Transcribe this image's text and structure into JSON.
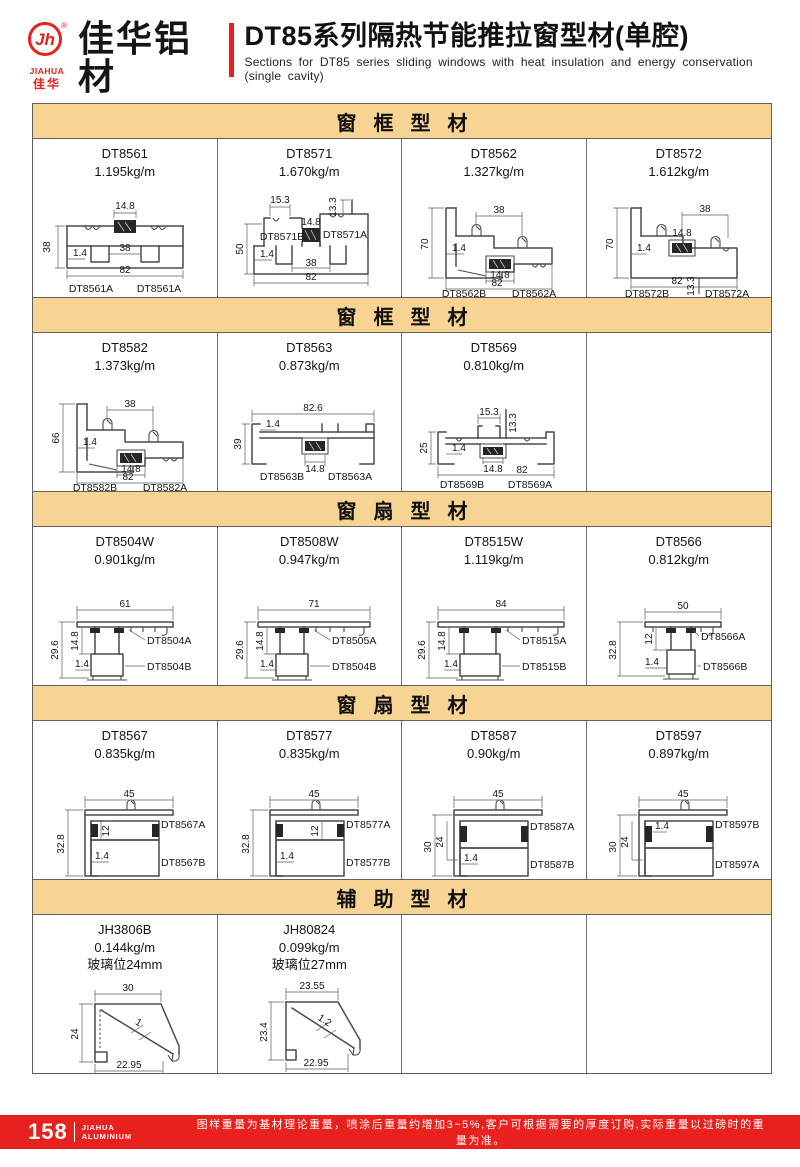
{
  "brand": {
    "monogram": "Jh",
    "registered": "®",
    "name_en": "JIAHUA",
    "name_cn_small": "佳华",
    "name": "佳华铝材",
    "slogan": "世界利中华 · 铝材用佳华"
  },
  "title": {
    "cn": "DT85系列隔热节能推拉窗型材(单腔)",
    "en": "Sections for DT85 series sliding windows with heat insulation and energy conservation (single cavity)"
  },
  "colors": {
    "accent_red": "#e8201e",
    "band_tan": "#f7d494"
  },
  "sections": [
    {
      "title": "窗框型材",
      "cells": [
        {
          "code": "DT8561",
          "weight": "1.195kg/m",
          "d": {
            "top": "14.8",
            "left": "38",
            "wall": "1.4",
            "inner": "38",
            "overall": "82",
            "lbl_l": "DT8561A",
            "lbl_r": "DT8561A"
          }
        },
        {
          "code": "DT8571",
          "weight": "1.670kg/m",
          "d": {
            "top_left": "15.3",
            "top_right": "13.3",
            "center": "14.8",
            "left": "50",
            "wall": "1.4",
            "inner": "38",
            "overall": "82",
            "lbl_l": "DT8571B",
            "lbl_r": "DT8571A"
          }
        },
        {
          "code": "DT8562",
          "weight": "1.327kg/m",
          "d": {
            "top": "38",
            "left": "70",
            "wall": "1.4",
            "center": "14.8",
            "overall": "82",
            "lbl_l": "DT8562B",
            "lbl_r": "DT8562A"
          }
        },
        {
          "code": "DT8572",
          "weight": "1.612kg/m",
          "d": {
            "top": "38",
            "left": "70",
            "wall": "1.4",
            "center": "14.8",
            "overall": "82",
            "right": "13.3",
            "lbl_l": "DT8572B",
            "lbl_r": "DT8572A"
          }
        }
      ]
    },
    {
      "title": "窗框型材",
      "cells": [
        {
          "code": "DT8582",
          "weight": "1.373kg/m",
          "d": {
            "top": "38",
            "left": "66",
            "wall": "1.4",
            "center": "14.8",
            "overall": "82",
            "lbl_l": "DT8582B",
            "lbl_r": "DT8582A"
          }
        },
        {
          "code": "DT8563",
          "weight": "0.873kg/m",
          "d": {
            "top": "82.6",
            "left": "39",
            "wall": "1.4",
            "center": "14.8",
            "lbl_l": "DT8563B",
            "lbl_r": "DT8563A"
          }
        },
        {
          "code": "DT8569",
          "weight": "0.810kg/m",
          "d": {
            "top_left": "15.3",
            "top_right": "13.3",
            "left": "25",
            "wall": "1.4",
            "center": "14.8",
            "overall": "82",
            "lbl_l": "DT8569B",
            "lbl_r": "DT8569A"
          }
        }
      ]
    },
    {
      "title": "窗扇型材",
      "cells": [
        {
          "code": "DT8504W",
          "weight": "0.901kg/m",
          "d": {
            "top": "61",
            "left": "29.6",
            "inner": "14.8",
            "wall": "1.4",
            "lbl_t": "DT8504A",
            "lbl_b": "DT8504B"
          }
        },
        {
          "code": "DT8508W",
          "weight": "0.947kg/m",
          "d": {
            "top": "71",
            "left": "29.6",
            "inner": "14.8",
            "wall": "1.4",
            "lbl_t": "DT8505A",
            "lbl_b": "DT8504B"
          }
        },
        {
          "code": "DT8515W",
          "weight": "1.119kg/m",
          "d": {
            "top": "84",
            "left": "29.6",
            "inner": "14.8",
            "wall": "1.4",
            "lbl_t": "DT8515A",
            "lbl_b": "DT8515B"
          }
        },
        {
          "code": "DT8566",
          "weight": "0.812kg/m",
          "d": {
            "top": "50",
            "left": "32.8",
            "inner": "12",
            "wall": "1.4",
            "lbl_t": "DT8566A",
            "lbl_b": "DT8566B"
          }
        }
      ]
    },
    {
      "title": "窗扇型材",
      "cells": [
        {
          "code": "DT8567",
          "weight": "0.835kg/m",
          "d": {
            "top": "45",
            "left": "32.8",
            "inner": "12",
            "wall": "1.4",
            "lbl_t": "DT8567A",
            "lbl_b": "DT8567B"
          }
        },
        {
          "code": "DT8577",
          "weight": "0.835kg/m",
          "d": {
            "top": "45",
            "left": "32.8",
            "inner": "12",
            "wall": "1.4",
            "lbl_t": "DT8577A",
            "lbl_b": "DT8577B"
          }
        },
        {
          "code": "DT8587",
          "weight": "0.90kg/m",
          "d": {
            "top": "45",
            "left": "30",
            "inner": "24",
            "wall": "1.4",
            "lbl_t": "DT8587A",
            "lbl_b": "DT8587B"
          }
        },
        {
          "code": "DT8597",
          "weight": "0.897kg/m",
          "d": {
            "top": "45",
            "left": "30",
            "inner": "24",
            "wall": "1.4",
            "lbl_t": "DT8597B",
            "lbl_b": "DT8597A"
          }
        }
      ]
    },
    {
      "title": "辅助型材",
      "cells": [
        {
          "code": "JH3806B",
          "weight": "0.144kg/m",
          "note": "玻璃位24mm",
          "d": {
            "top": "30",
            "left": "24",
            "wall": "1",
            "bottom": "22.95"
          }
        },
        {
          "code": "JH80824",
          "weight": "0.099kg/m",
          "note": "玻璃位27mm",
          "d": {
            "top": "23.55",
            "left": "23.4",
            "wall": "1.2",
            "bottom": "22.95"
          }
        }
      ]
    }
  ],
  "footer": {
    "page_number": "158",
    "brand_top": "JIAHUA",
    "brand_bottom": "ALUMINIUM",
    "note": "图样重量为基材理论重量，喷涂后重量约增加3~5%,客户可根据需要的厚度订购,实际重量以过磅时的重量为准。"
  }
}
